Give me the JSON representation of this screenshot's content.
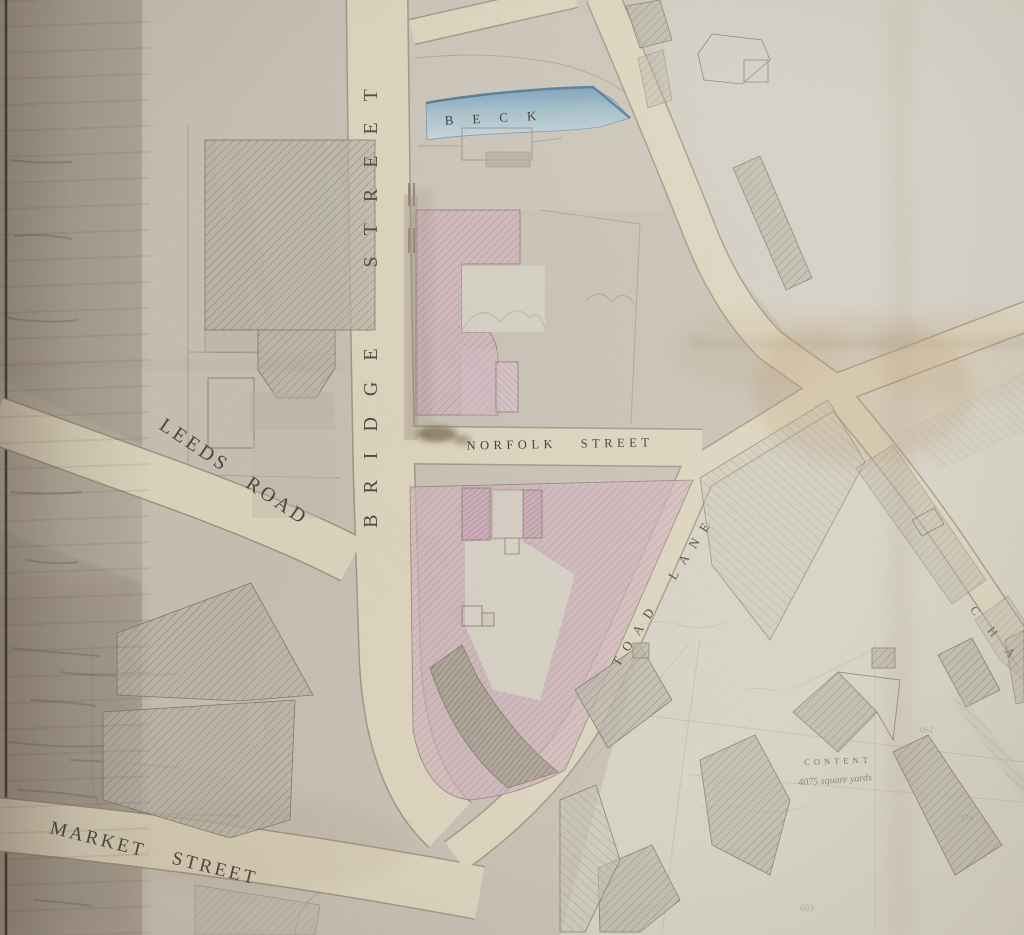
{
  "labels": {
    "beck": "BECK",
    "bridge_street": "BRIDGE STREET",
    "leeds_road": "LEEDS ROAD",
    "norfolk_street": "NORFOLK STREET",
    "toad_lane": "TOAD LANE",
    "market_street": "MARKET STREET",
    "chapel_partial": "C H A",
    "content": "CONTENT",
    "content_area": "4075 square yards"
  },
  "pencil": [
    "062",
    "174",
    "603"
  ],
  "colors": {
    "paper": "#c7bfb3",
    "paper_dark_edge": "#afa598",
    "paper_light": "#d7d2c6",
    "road_fill": "#ddd4bd",
    "boundary_line": "#9a8b79",
    "building_grey": "#b6b0a4",
    "building_pink": "#cbadb8",
    "beck_blue": "#86abc2",
    "ink": "#2f2b26",
    "stain_brown": "#a97f45"
  }
}
